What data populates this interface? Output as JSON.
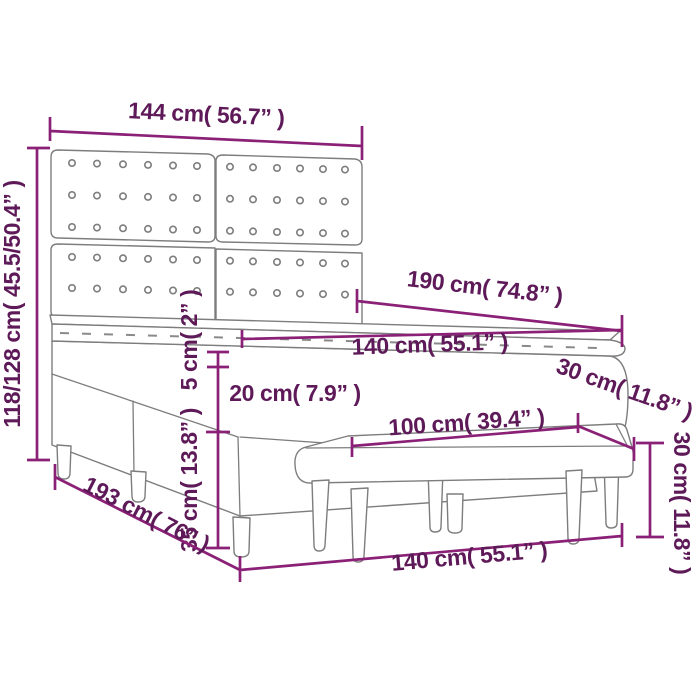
{
  "diagram": {
    "title": "box-spring-bed-with-headboard-and-bench-dimension-diagram",
    "colors": {
      "dimension_line": "#8B2077",
      "dimension_text": "#5E1A58",
      "furniture_outline": "#7d7d7d",
      "background": "#ffffff"
    },
    "labels": {
      "headboard_width": "144 cm( 56.7” )",
      "total_height": "118/128 cm( 45.5/50.4” )",
      "bed_length": "190 cm( 74.8” )",
      "mattress_width": "140 cm( 55.1” )",
      "topper_height": "5 cm( 2” )",
      "mattress_height": "20 cm( 7.9” )",
      "base_height": "35 cm( 13.8” )",
      "base_length": "193 cm( 76” )",
      "bench_seat_width": "100 cm( 39.4” )",
      "bench_depth": "30 cm( 11.8” )",
      "bench_height": "30 cm( 11.8” )",
      "bed_width_bottom": "140 cm( 55.1” )"
    }
  }
}
